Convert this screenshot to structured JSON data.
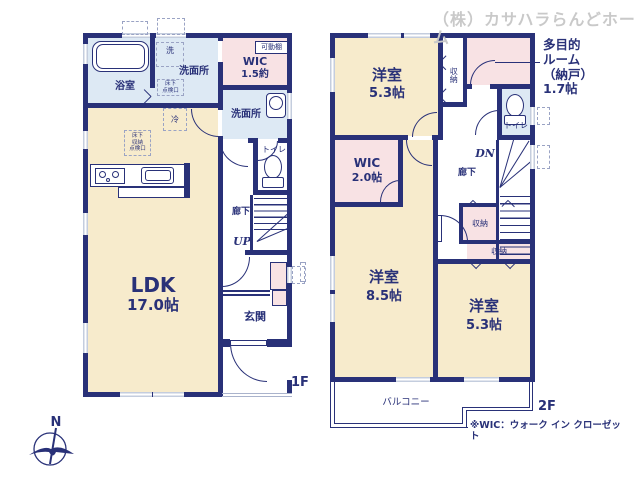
{
  "notes": {
    "watermark": "（株）カサハラらんどホーム",
    "wic_note": "※WIC：ウォーク イン クローゼット",
    "north": "N"
  },
  "colors": {
    "wall": "#293178",
    "cream": "#f7ebcc",
    "pink": "#f8e2e4",
    "blue": "#dde9f4",
    "win": "#c4cdde",
    "dash": "#9aa3c4",
    "thin": "#aab3cc",
    "watermark": "#c9c9c9"
  },
  "floor1": {
    "label": "1F",
    "bathroom": "浴室",
    "washer": "洗",
    "washroom_top": "洗面所",
    "hatch_top": "床下\n点検口",
    "movable_shelf": "可動棚",
    "wic_name": "WIC",
    "wic_size": "1.5約",
    "washroom_right": "洗面所",
    "fridge": "冷",
    "floor_storage": "床下\n収納\n点検口",
    "toilet": "トイレ",
    "hallway": "廊下",
    "up": "UP",
    "ldk_name": "LDK",
    "ldk_size": "17.0帖",
    "entrance": "玄関"
  },
  "floor2": {
    "label": "2F",
    "bedroom_top_name": "洋室",
    "bedroom_top_size": "5.3帖",
    "closet_top": "収納",
    "multipurpose": "多目的\nルーム\n（納戸）\n1.7帖",
    "toilet": "トイレ",
    "dn": "DN",
    "hallway": "廊下",
    "wic_name": "WIC",
    "wic_size": "2.0帖",
    "bedroom_left_name": "洋室",
    "bedroom_left_size": "8.5帖",
    "closet_mid": "収納",
    "closet_wide": "収納",
    "bedroom_right_name": "洋室",
    "bedroom_right_size": "5.3帖",
    "balcony": "バルコニー"
  }
}
